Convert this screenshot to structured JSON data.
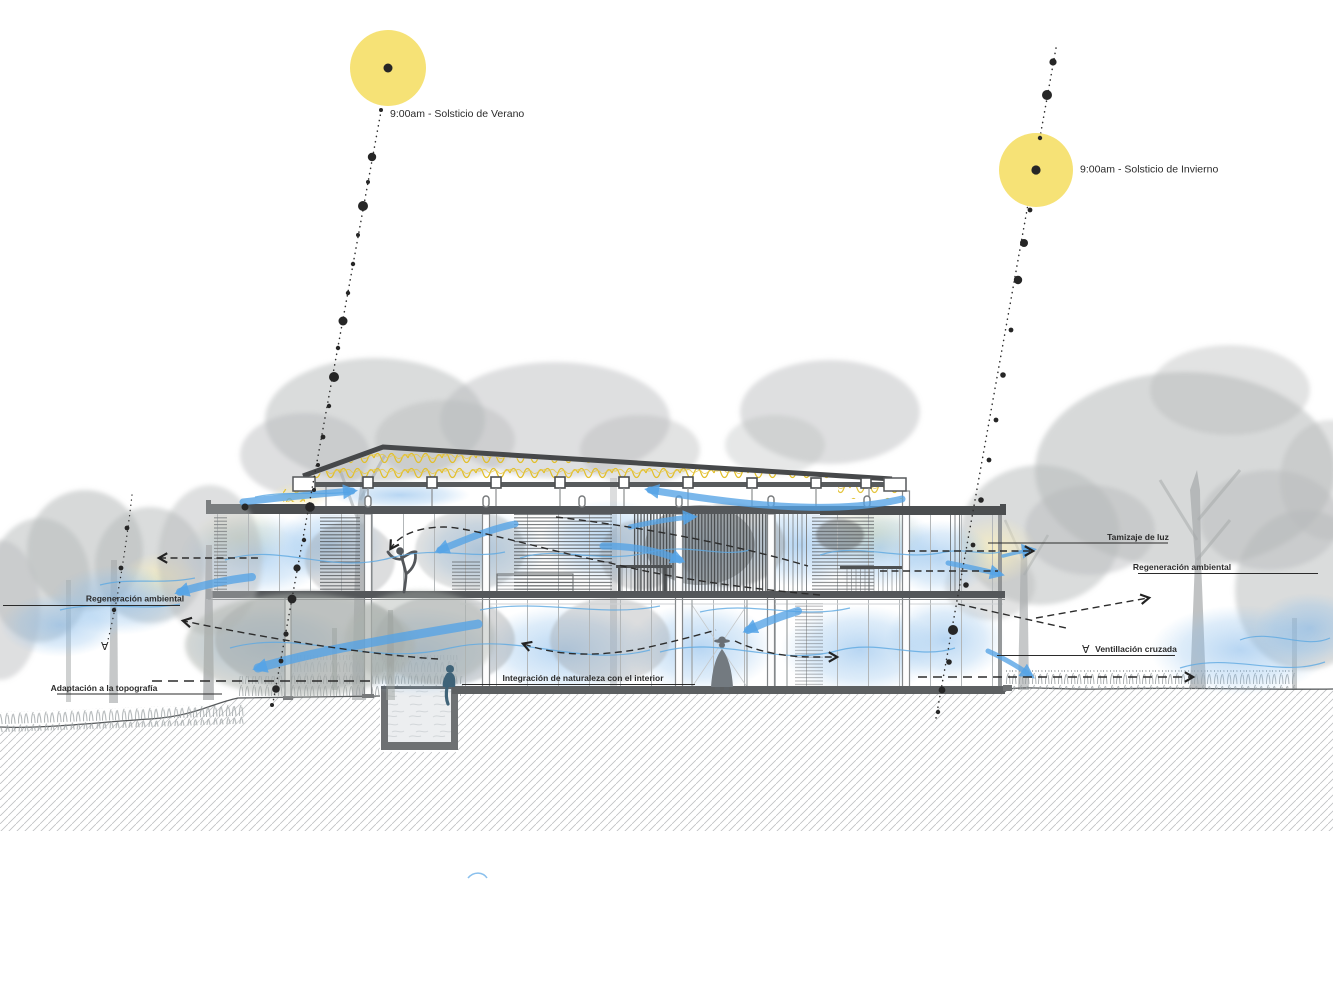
{
  "diagram": {
    "sun_summer": {
      "label": "9:00am - Solsticio de Verano"
    },
    "sun_winter": {
      "label": "9:00am - Solsticio de Invierno"
    },
    "annotations": {
      "tamizaje": "Tamizaje de luz",
      "regeneracion_right": "Regeneración ambiental",
      "ventilacion": "Ventillación cruzada",
      "regeneracion_left": "Regeneración ambiental",
      "adaptacion": "Adaptación a la topografía",
      "integracion": "Integración de naturaleza con el interior"
    },
    "icons": {
      "flow_marker": "∀"
    },
    "colors": {
      "sun": "#F6E276",
      "airflow": "#55A3E6",
      "insulation": "#E2BF2A",
      "foliage": "#B6B9BA",
      "structure": "#54575A",
      "ink": "#2B2B2B"
    }
  }
}
